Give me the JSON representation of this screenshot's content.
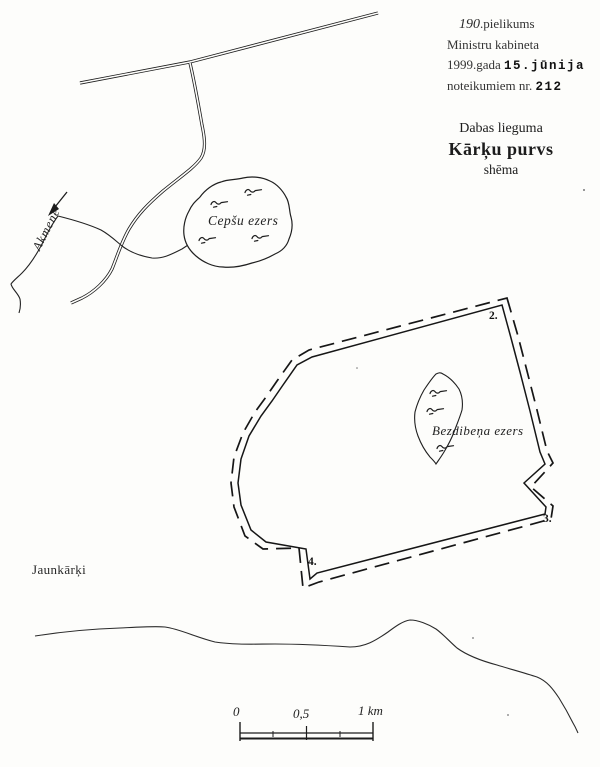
{
  "document": {
    "annex_note": {
      "number": "190",
      "suffix": ".pielikums",
      "line2": "Ministru kabineta",
      "line3_text": "1999.gada ",
      "line3_date": "15.jūnija",
      "line4_text": "noteikumiem nr. ",
      "line4_number": "212"
    },
    "title": {
      "line1": "Dabas lieguma",
      "line2": "Kārķu purvs",
      "line3": "shēma"
    }
  },
  "map": {
    "river_label": "Akmene",
    "lake_cepsu_label": "Cepšu ezers",
    "lake_bezdibena_label": "Bezdibeņa ezers",
    "settlement_label": "Jaunkārķi",
    "boundary_markers": [
      {
        "label": "2."
      },
      {
        "label": "3."
      },
      {
        "label": "4."
      }
    ],
    "scale_bar": {
      "start": "0",
      "middle": "0,5",
      "end": "1 km"
    },
    "icons": {
      "flow_arrow": "flow-direction-arrow",
      "marsh": "marsh-symbol"
    },
    "colors": {
      "ink": "#1f1f1f",
      "paper": "#fdfdfb"
    }
  }
}
